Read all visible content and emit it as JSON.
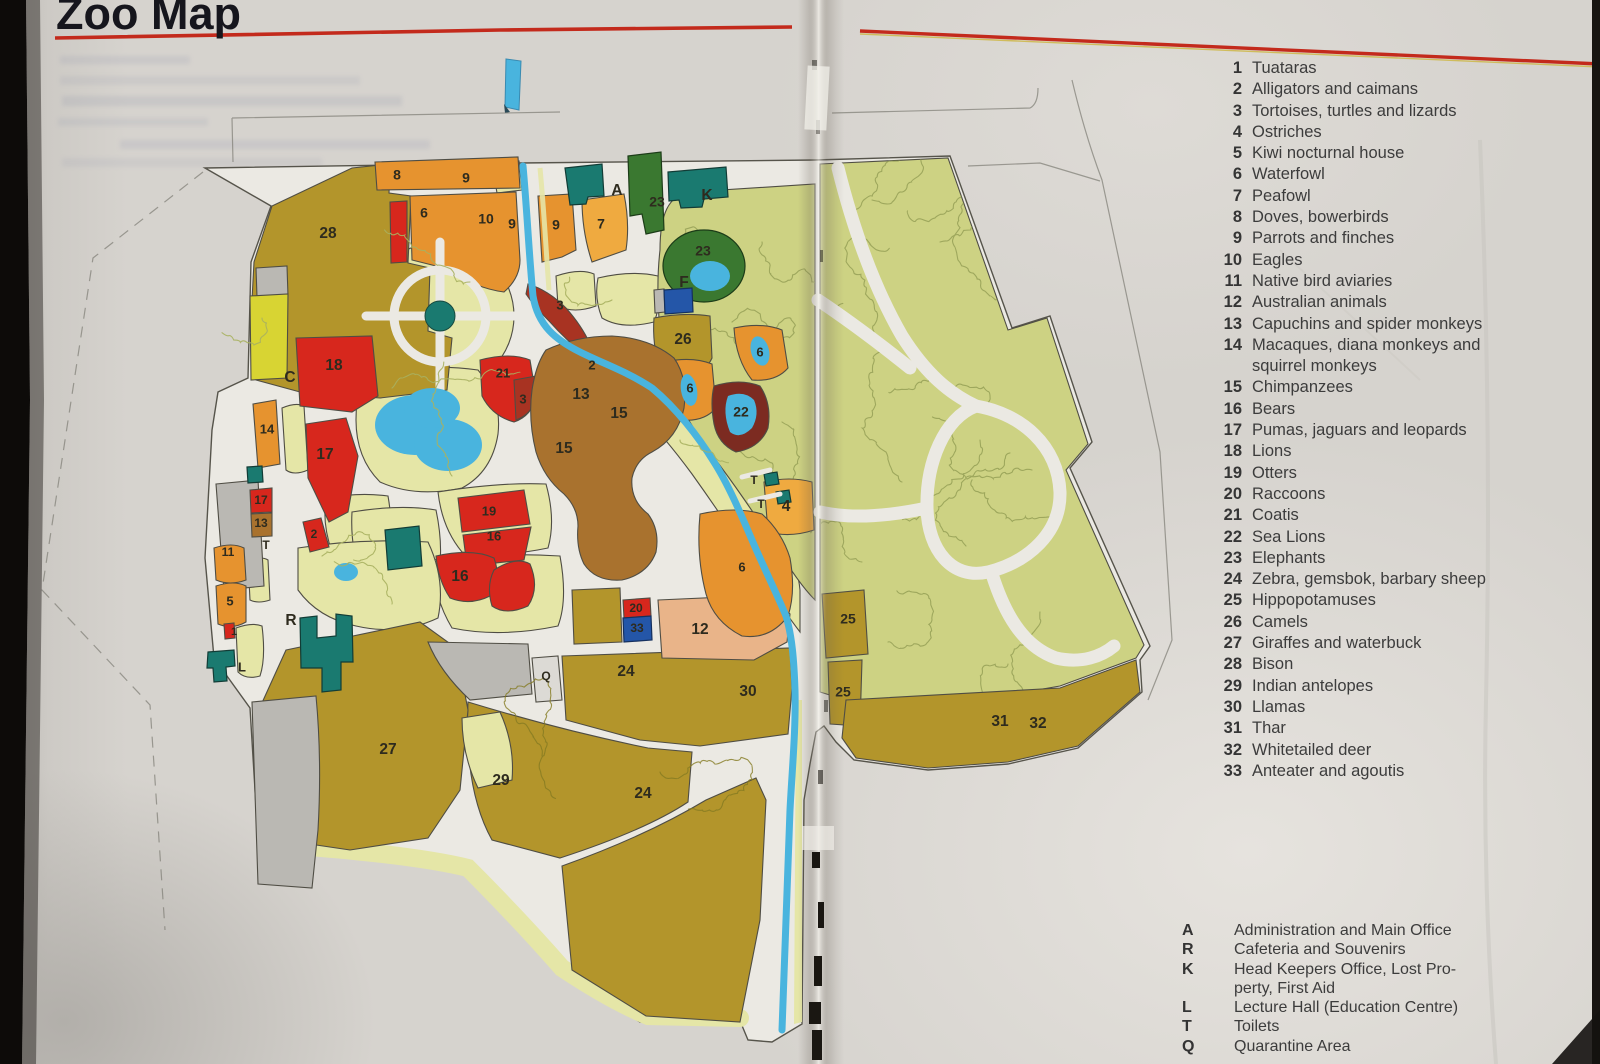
{
  "page": {
    "title": "Zoo Map"
  },
  "legend": {
    "items": [
      {
        "n": "1",
        "name": "Tuataras"
      },
      {
        "n": "2",
        "name": "Alligators and caimans"
      },
      {
        "n": "3",
        "name": "Tortoises, turtles and lizards"
      },
      {
        "n": "4",
        "name": "Ostriches"
      },
      {
        "n": "5",
        "name": "Kiwi nocturnal house"
      },
      {
        "n": "6",
        "name": "Waterfowl"
      },
      {
        "n": "7",
        "name": "Peafowl"
      },
      {
        "n": "8",
        "name": "Doves, bowerbirds"
      },
      {
        "n": "9",
        "name": "Parrots and finches"
      },
      {
        "n": "10",
        "name": "Eagles"
      },
      {
        "n": "11",
        "name": "Native bird aviaries"
      },
      {
        "n": "12",
        "name": "Australian animals"
      },
      {
        "n": "13",
        "name": "Capuchins and spider monkeys"
      },
      {
        "n": "14",
        "name": "Macaques,  diana  monkeys  and\nsquirrel monkeys"
      },
      {
        "n": "15",
        "name": "Chimpanzees"
      },
      {
        "n": "16",
        "name": "Bears"
      },
      {
        "n": "17",
        "name": "Pumas, jaguars and leopards"
      },
      {
        "n": "18",
        "name": "Lions"
      },
      {
        "n": "19",
        "name": "Otters"
      },
      {
        "n": "20",
        "name": "Raccoons"
      },
      {
        "n": "21",
        "name": "Coatis"
      },
      {
        "n": "22",
        "name": "Sea Lions"
      },
      {
        "n": "23",
        "name": "Elephants"
      },
      {
        "n": "24",
        "name": "Zebra,  gemsbok,  barbary sheep"
      },
      {
        "n": "25",
        "name": "Hippopotamuses"
      },
      {
        "n": "26",
        "name": "Camels"
      },
      {
        "n": "27",
        "name": "Giraffes and waterbuck"
      },
      {
        "n": "28",
        "name": "Bison"
      },
      {
        "n": "29",
        "name": "Indian antelopes"
      },
      {
        "n": "30",
        "name": "Llamas"
      },
      {
        "n": "31",
        "name": "Thar"
      },
      {
        "n": "32",
        "name": "Whitetailed deer"
      },
      {
        "n": "33",
        "name": "Anteater and agoutis"
      }
    ]
  },
  "facilities": {
    "items": [
      {
        "k": "A",
        "name": "Administration and Main Office"
      },
      {
        "k": "R",
        "name": "Cafeteria and Souvenirs"
      },
      {
        "k": "K",
        "name": "Head  Keepers  Office,  Lost  Pro-\nperty, First Aid"
      },
      {
        "k": "L",
        "name": "Lecture Hall (Education Centre)"
      },
      {
        "k": "T",
        "name": "Toilets"
      },
      {
        "k": "Q",
        "name": "Quarantine Area"
      }
    ]
  },
  "map": {
    "markers": [
      {
        "t": "28",
        "x": 328,
        "y": 234
      },
      {
        "t": "8",
        "x": 397,
        "y": 176,
        "s": 14
      },
      {
        "t": "9",
        "x": 466,
        "y": 179,
        "s": 14
      },
      {
        "t": "6",
        "x": 424,
        "y": 214,
        "s": 14
      },
      {
        "t": "10",
        "x": 486,
        "y": 220,
        "s": 14
      },
      {
        "t": "9",
        "x": 512,
        "y": 225,
        "s": 14
      },
      {
        "t": "9",
        "x": 556,
        "y": 226,
        "s": 14
      },
      {
        "t": "7",
        "x": 601,
        "y": 225,
        "s": 14
      },
      {
        "t": "23",
        "x": 657,
        "y": 203,
        "s": 14
      },
      {
        "t": "A",
        "x": 617,
        "y": 191
      },
      {
        "t": "K",
        "x": 707,
        "y": 196
      },
      {
        "t": "23",
        "x": 703,
        "y": 252,
        "s": 14
      },
      {
        "t": "F",
        "x": 684,
        "y": 283
      },
      {
        "t": "26",
        "x": 683,
        "y": 340
      },
      {
        "t": "6",
        "x": 760,
        "y": 353,
        "s": 13
      },
      {
        "t": "3",
        "x": 560,
        "y": 306,
        "s": 13
      },
      {
        "t": "2",
        "x": 592,
        "y": 366,
        "s": 13
      },
      {
        "t": "21",
        "x": 503,
        "y": 374,
        "s": 13
      },
      {
        "t": "3",
        "x": 523,
        "y": 400,
        "s": 13
      },
      {
        "t": "18",
        "x": 334,
        "y": 366
      },
      {
        "t": "C",
        "x": 290,
        "y": 378
      },
      {
        "t": "14",
        "x": 267,
        "y": 430,
        "s": 13
      },
      {
        "t": "17",
        "x": 325,
        "y": 455
      },
      {
        "t": "13",
        "x": 581,
        "y": 395
      },
      {
        "t": "15",
        "x": 619,
        "y": 414
      },
      {
        "t": "15",
        "x": 564,
        "y": 449
      },
      {
        "t": "6",
        "x": 690,
        "y": 389,
        "s": 13
      },
      {
        "t": "22",
        "x": 741,
        "y": 413,
        "s": 14
      },
      {
        "t": "2",
        "x": 314,
        "y": 535,
        "s": 12
      },
      {
        "t": "17",
        "x": 261,
        "y": 501,
        "s": 12
      },
      {
        "t": "13",
        "x": 261,
        "y": 524,
        "s": 12
      },
      {
        "t": "T",
        "x": 266,
        "y": 546,
        "s": 12
      },
      {
        "t": "11",
        "x": 228,
        "y": 553,
        "s": 12
      },
      {
        "t": "19",
        "x": 489,
        "y": 512,
        "s": 13
      },
      {
        "t": "16",
        "x": 494,
        "y": 537,
        "s": 13
      },
      {
        "t": "5",
        "x": 230,
        "y": 602,
        "s": 13
      },
      {
        "t": "1",
        "x": 234,
        "y": 632,
        "s": 11
      },
      {
        "t": "16",
        "x": 460,
        "y": 577
      },
      {
        "t": "6",
        "x": 742,
        "y": 568,
        "s": 13
      },
      {
        "t": "T",
        "x": 754,
        "y": 481,
        "s": 12
      },
      {
        "t": "T",
        "x": 761,
        "y": 505,
        "s": 12
      },
      {
        "t": "4",
        "x": 786,
        "y": 507
      },
      {
        "t": "R",
        "x": 291,
        "y": 621
      },
      {
        "t": "L",
        "x": 242,
        "y": 668,
        "s": 13
      },
      {
        "t": "20",
        "x": 636,
        "y": 609,
        "s": 12
      },
      {
        "t": "33",
        "x": 637,
        "y": 629,
        "s": 12
      },
      {
        "t": "12",
        "x": 700,
        "y": 630
      },
      {
        "t": "Q",
        "x": 546,
        "y": 677,
        "s": 12
      },
      {
        "t": "25",
        "x": 848,
        "y": 620,
        "s": 14
      },
      {
        "t": "24",
        "x": 626,
        "y": 672
      },
      {
        "t": "30",
        "x": 748,
        "y": 692
      },
      {
        "t": "25",
        "x": 843,
        "y": 693,
        "s": 14
      },
      {
        "t": "27",
        "x": 388,
        "y": 750
      },
      {
        "t": "29",
        "x": 501,
        "y": 781
      },
      {
        "t": "24",
        "x": 643,
        "y": 794
      },
      {
        "t": "31",
        "x": 1000,
        "y": 722
      },
      {
        "t": "32",
        "x": 1038,
        "y": 724
      }
    ]
  },
  "colors": {
    "paper": "#d6d3ce",
    "road": "#ebe9e3",
    "olive": "#b3952b",
    "paleYellow": "#e5e6a7",
    "forest": "#cdd283",
    "scribble": "#8e9950",
    "orange": "#e6932f",
    "orangeLight": "#efaa40",
    "salmon": "#e9b489",
    "red": "#d7271d",
    "darkRed": "#a83322",
    "maroon": "#7c2b21",
    "brown": "#a9722e",
    "water": "#49b4de",
    "teal": "#1a7a70",
    "darkGreen": "#3a7830",
    "blue": "#2456a8",
    "gray": "#bab8b3",
    "yellow": "#d8d433",
    "ink": "#2e2b1e",
    "legendText": "#3c3c3c",
    "titleColor": "#16161d",
    "redLine": "#c32a1c",
    "outline": "#4f4d44"
  }
}
